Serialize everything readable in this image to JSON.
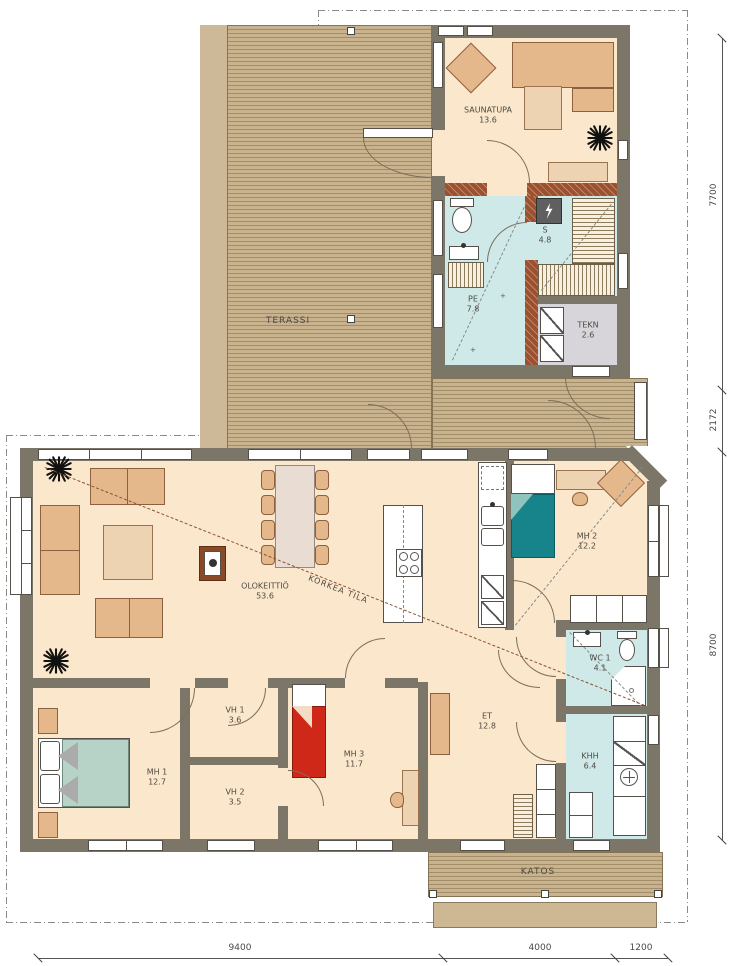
{
  "plan": {
    "rooms": {
      "terassi": {
        "name": "TERASSI"
      },
      "saunatupa": {
        "name": "SAUNATUPA",
        "area": "13.6"
      },
      "pe": {
        "name": "PE",
        "area": "7.8"
      },
      "s": {
        "name": "S",
        "area": "4.8"
      },
      "tekn": {
        "name": "TEKN",
        "area": "2.6"
      },
      "olokeittio": {
        "name": "OLOKEITTIÖ",
        "area": "53.6"
      },
      "korkea": {
        "name": "KORKEA TILA"
      },
      "mh1": {
        "name": "MH 1",
        "area": "12.7"
      },
      "mh2": {
        "name": "MH 2",
        "area": "12.2"
      },
      "mh3": {
        "name": "MH 3",
        "area": "11.7"
      },
      "vh1": {
        "name": "VH 1",
        "area": "3.6"
      },
      "vh2": {
        "name": "VH 2",
        "area": "3.5"
      },
      "wc1": {
        "name": "WC 1",
        "area": "4.1"
      },
      "khh": {
        "name": "KHH",
        "area": "6.4"
      },
      "et": {
        "name": "ET",
        "area": "12.8"
      },
      "katos": {
        "name": "KATOS"
      }
    },
    "dimensions": {
      "right": [
        "7700",
        "2172",
        "8700"
      ],
      "bottom": [
        "9400",
        "4000",
        "1200"
      ]
    },
    "colors": {
      "wall": "#7c7668",
      "log_wall": "#9b5130",
      "floor": "#fbe7cb",
      "wet_floor": "#cfe9e9",
      "tech_floor": "#d8d5da",
      "deck": "#c9b38e",
      "furniture": "#e5b88c",
      "bed_teal": "#17838a",
      "bed_red": "#d02818",
      "bed_green": "#b7d2c6"
    }
  }
}
